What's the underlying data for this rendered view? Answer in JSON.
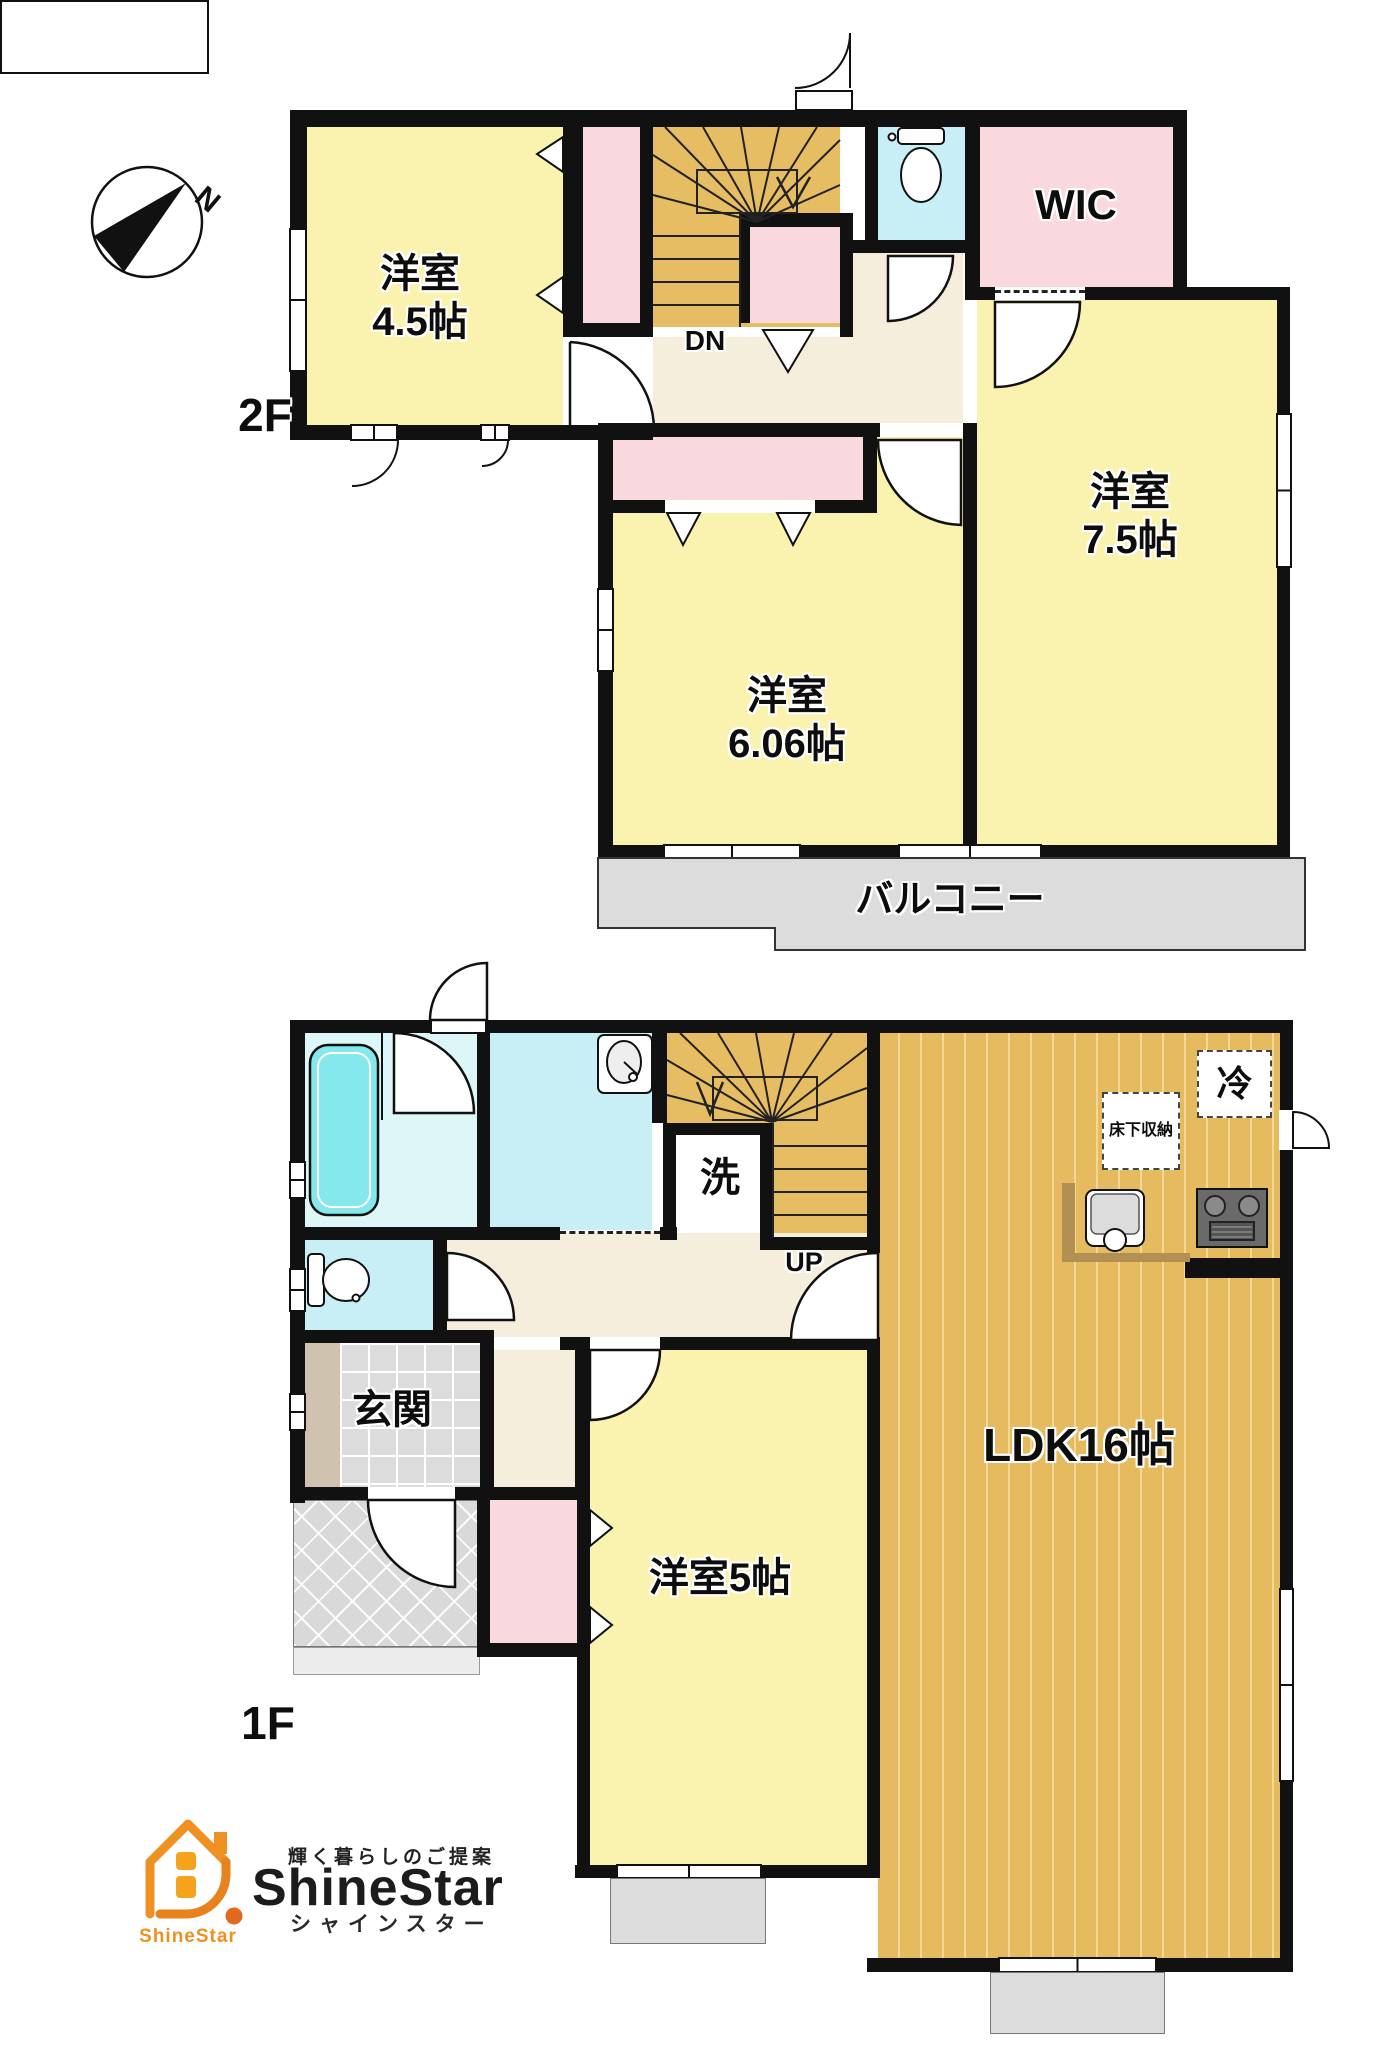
{
  "floor2": {
    "label": "2F",
    "rooms": {
      "bedroom45": {
        "name": "洋室",
        "size": "4.5帖"
      },
      "wic": "WIC",
      "bedroom75": {
        "name": "洋室",
        "size": "7.5帖"
      },
      "bedroom606": {
        "name": "洋室",
        "size": "6.06帖"
      },
      "balcony": "バルコニー",
      "stairs": "DN"
    }
  },
  "floor1": {
    "label": "1F",
    "rooms": {
      "ldk": "LDK16帖",
      "bedroom5": "洋室5帖",
      "entrance": "玄関",
      "laundry": "洗",
      "stairs": "UP",
      "refrigerator": "冷",
      "underfloor_storage": "床下収納"
    }
  },
  "compass": {
    "north": "N"
  },
  "logo": {
    "tagline": "輝く暮らしのご提案",
    "brand": "ShineStar",
    "brand_kana": "シャインスター",
    "icon_caption": "ShineStar"
  },
  "colors": {
    "wall": "#111111",
    "room_yellow": "#FAF3AF",
    "closet_pink": "#FAD9DE",
    "stairs_tan": "#E7BD63",
    "wood_floor": "#E6BA5E",
    "water_cyan": "#C9EFF6",
    "bathtub_cyan": "#85E8EC",
    "hall_cream": "#F6EEDC",
    "balcony_gray": "#DCDCDC",
    "brand_orange": "#EF9122"
  }
}
